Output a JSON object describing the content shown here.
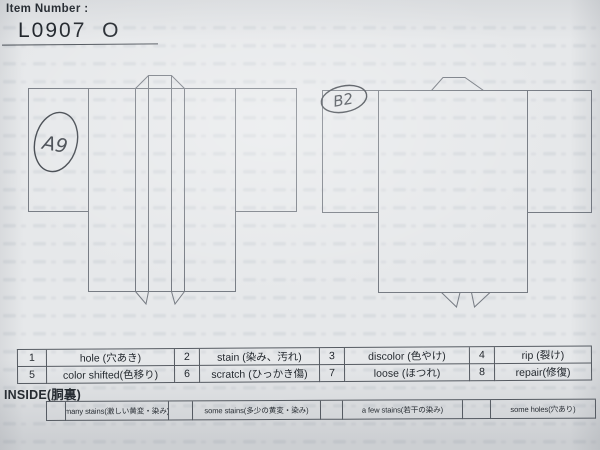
{
  "colors": {
    "paper": "#e6e8ea",
    "line": "#767b83",
    "pen": "#41464d",
    "ink": "#2f343a"
  },
  "header": {
    "label": "Item Number :",
    "value": "L0907  O"
  },
  "diagrams": {
    "front": {
      "annotation": "A9"
    },
    "back": {
      "annotation": "B2"
    }
  },
  "defect_table": {
    "rows": [
      [
        "1",
        "hole (穴あき)",
        "2",
        "stain (染み、汚れ)",
        "3",
        "discolor (色やけ)",
        "4",
        "rip (裂け)"
      ],
      [
        "5",
        "color shifted(色移り)",
        "6",
        "scratch (ひっかき傷)",
        "7",
        "loose (ほつれ)",
        "8",
        "repair(修復)"
      ]
    ]
  },
  "inside_section": {
    "label": "INSIDE(胴裏)",
    "cells": [
      "",
      "many stains(激しい黄変・染み)",
      "",
      "some stains(多少の黄変・染み)",
      "",
      "a few stains(若干の染み)",
      "",
      "some holes(穴あり)"
    ]
  }
}
